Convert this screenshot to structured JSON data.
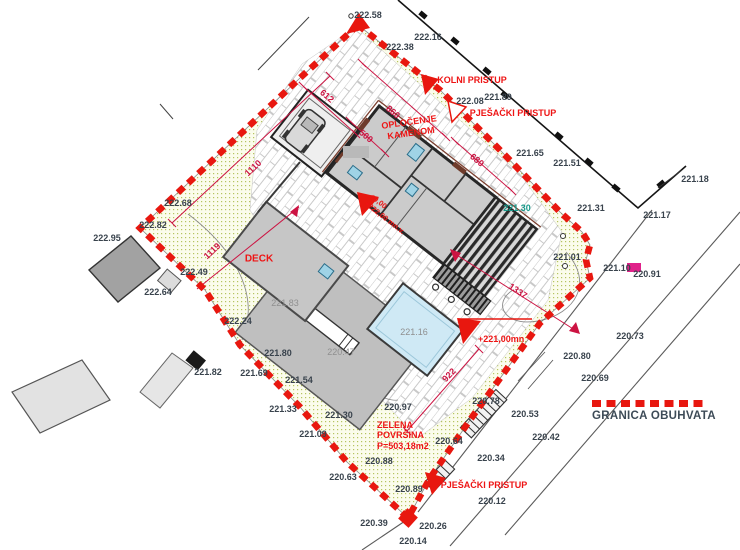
{
  "legend": {
    "label": "GRANICA OBUHVATA"
  },
  "annotations": {
    "kolni_pristup": "KOLNI PRISTUP",
    "pjesacki_pristup_top": "PJEŠAČKI PRISTUP",
    "pjesacki_pristup_bottom": "PJEŠAČKI PRISTUP",
    "oplocenje_line1": "OPLOČENJE",
    "oplocenje_line2": "KAMENOM",
    "deck": "DECK",
    "zelena_line1": "ZELENA",
    "zelena_line2": "POVRŠINA",
    "zelena_line3": "P=503,18m2",
    "level_zero_line1": "±0,00",
    "level_zero_line2": "+222,00 mn.v.",
    "level_terrace": "+221,00mn"
  },
  "elevation_points": [
    {
      "t": "222.58",
      "x": 368,
      "y": 15
    },
    {
      "t": "222.16",
      "x": 428,
      "y": 37
    },
    {
      "t": "222.38",
      "x": 400,
      "y": 47
    },
    {
      "t": "222.08",
      "x": 470,
      "y": 101
    },
    {
      "t": "221.89",
      "x": 498,
      "y": 97
    },
    {
      "t": "221.65",
      "x": 530,
      "y": 153
    },
    {
      "t": "221.51",
      "x": 567,
      "y": 163
    },
    {
      "t": "221.18",
      "x": 695,
      "y": 179
    },
    {
      "t": "221.31",
      "x": 591,
      "y": 208
    },
    {
      "t": "221.17",
      "x": 657,
      "y": 215
    },
    {
      "t": "222.95",
      "x": 107,
      "y": 238
    },
    {
      "t": "222.68",
      "x": 178,
      "y": 203
    },
    {
      "t": "222.82",
      "x": 153,
      "y": 225
    },
    {
      "t": "222.49",
      "x": 194,
      "y": 272
    },
    {
      "t": "222.64",
      "x": 158,
      "y": 292
    },
    {
      "t": "222.24",
      "x": 238,
      "y": 321
    },
    {
      "t": "221.01",
      "x": 567,
      "y": 257
    },
    {
      "t": "221.10",
      "x": 617,
      "y": 268
    },
    {
      "t": "220.91",
      "x": 647,
      "y": 274
    },
    {
      "t": "220.73",
      "x": 630,
      "y": 336
    },
    {
      "t": "220.80",
      "x": 577,
      "y": 356
    },
    {
      "t": "220.69",
      "x": 595,
      "y": 378
    },
    {
      "t": "221.82",
      "x": 208,
      "y": 372
    },
    {
      "t": "221.80",
      "x": 278,
      "y": 353
    },
    {
      "t": "221.69",
      "x": 254,
      "y": 373
    },
    {
      "t": "221.54",
      "x": 299,
      "y": 380
    },
    {
      "t": "221.33",
      "x": 283,
      "y": 409
    },
    {
      "t": "221.30",
      "x": 339,
      "y": 415
    },
    {
      "t": "221.09",
      "x": 313,
      "y": 434
    },
    {
      "t": "220.88",
      "x": 379,
      "y": 461
    },
    {
      "t": "220.63",
      "x": 343,
      "y": 477
    },
    {
      "t": "220.97",
      "x": 398,
      "y": 407
    },
    {
      "t": "220.78",
      "x": 486,
      "y": 401
    },
    {
      "t": "220.53",
      "x": 525,
      "y": 414
    },
    {
      "t": "220.42",
      "x": 546,
      "y": 437
    },
    {
      "t": "220.34",
      "x": 491,
      "y": 458
    },
    {
      "t": "220.64",
      "x": 449,
      "y": 441
    },
    {
      "t": "220.12",
      "x": 492,
      "y": 501
    },
    {
      "t": "220.39",
      "x": 374,
      "y": 523
    },
    {
      "t": "220.26",
      "x": 433,
      "y": 526
    },
    {
      "t": "220.14",
      "x": 413,
      "y": 541
    },
    {
      "t": "220.89",
      "x": 409,
      "y": 489
    },
    {
      "t": "221.30",
      "x": 517,
      "y": 208,
      "c": "teal"
    },
    {
      "t": "221.16",
      "x": 414,
      "y": 332,
      "c": "gray"
    },
    {
      "t": "221.83",
      "x": 285,
      "y": 303,
      "c": "gray"
    },
    {
      "t": "220.47",
      "x": 341,
      "y": 352,
      "c": "gray"
    }
  ],
  "dimension_labels": [
    {
      "t": "1110",
      "x": 253,
      "y": 168,
      "r": -43
    },
    {
      "t": "612",
      "x": 327,
      "y": 96,
      "r": 40
    },
    {
      "t": "500",
      "x": 366,
      "y": 136,
      "r": 40
    },
    {
      "t": "860",
      "x": 393,
      "y": 112,
      "r": 40
    },
    {
      "t": "680",
      "x": 477,
      "y": 160,
      "r": 40
    },
    {
      "t": "1119",
      "x": 212,
      "y": 251,
      "r": -43
    },
    {
      "t": "1337",
      "x": 518,
      "y": 291,
      "r": 34
    },
    {
      "t": "922",
      "x": 449,
      "y": 375,
      "r": -46
    }
  ],
  "colors": {
    "boundary_red": "#e8170f",
    "label_red": "#ee1414",
    "dimension_red": "#cc1342",
    "elevation_text": "#39434d",
    "teal_elevation": "#17998a",
    "green_area": "#b5c45f",
    "pool_blue": "#cfe9f5",
    "magenta_marker": "#e0218a"
  }
}
